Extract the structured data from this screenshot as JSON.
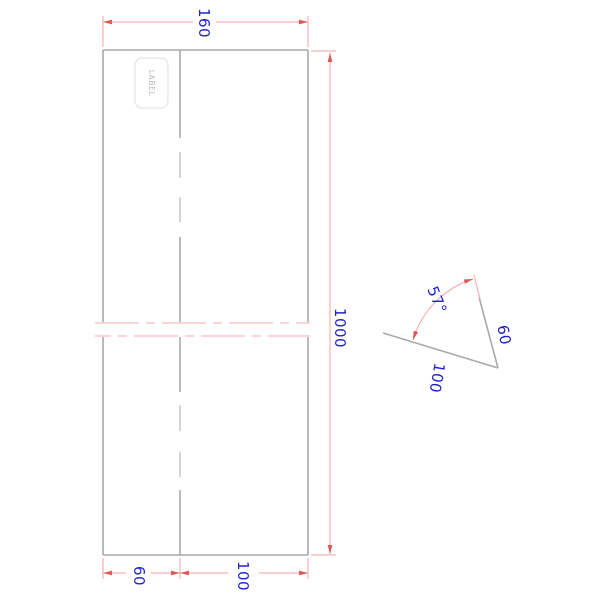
{
  "drawing": {
    "type": "technical-drawing-broken-view",
    "label_tag": "LABEL",
    "dim_width_top": "160",
    "dim_height_right": "1000",
    "dim_bottom_left": "60",
    "dim_bottom_right": "100"
  },
  "detail": {
    "angle": "57°",
    "side_length": "60",
    "base_length": "100"
  },
  "colors": {
    "outline_gray": "#a9a9a9",
    "hidden_dash_gray": "#c9c9c9",
    "dim_line_pink": "#f6b2b2",
    "break_line_pink": "#f8c6c6",
    "arrow_red": "#dd5a5a",
    "dim_text_blue": "#2121cd",
    "label_text_gray": "#bdbdbd",
    "label_border_gray": "#e4e4e4"
  }
}
